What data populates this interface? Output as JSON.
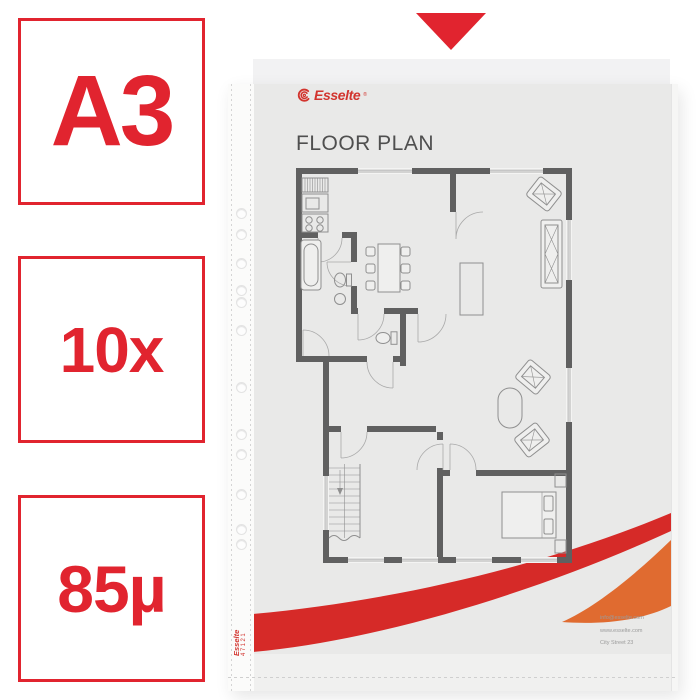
{
  "badges": [
    {
      "label": "A3"
    },
    {
      "label": "10x"
    },
    {
      "label": "85µ"
    }
  ],
  "pointer": {
    "shape": "triangle-down"
  },
  "document": {
    "brand": "Esselte",
    "registered": "®",
    "title": "FLOOR PLAN",
    "contact_lines": [
      "info@esselte.com",
      "www.esselte.com",
      "City Street 23"
    ],
    "spine_brand": "Esselte",
    "spine_code": "47121"
  },
  "pocket": {
    "hole_positions_px": [
      212,
      233,
      262,
      289,
      301,
      329,
      386,
      433,
      453,
      493,
      528,
      543
    ]
  },
  "colors": {
    "red": "#e1242f",
    "logo-red": "#d2342e",
    "swoosh-red": "#d62a28",
    "swoosh-orange": "#e06b30",
    "wall": "#606060",
    "furniture": "#8f8f8f",
    "paper": "#e9e9e8",
    "flap": "#f2f2f3",
    "pocket": "#f0f0ef",
    "title-gray": "#4f4f4f",
    "contact-gray": "#9b9b9b"
  }
}
